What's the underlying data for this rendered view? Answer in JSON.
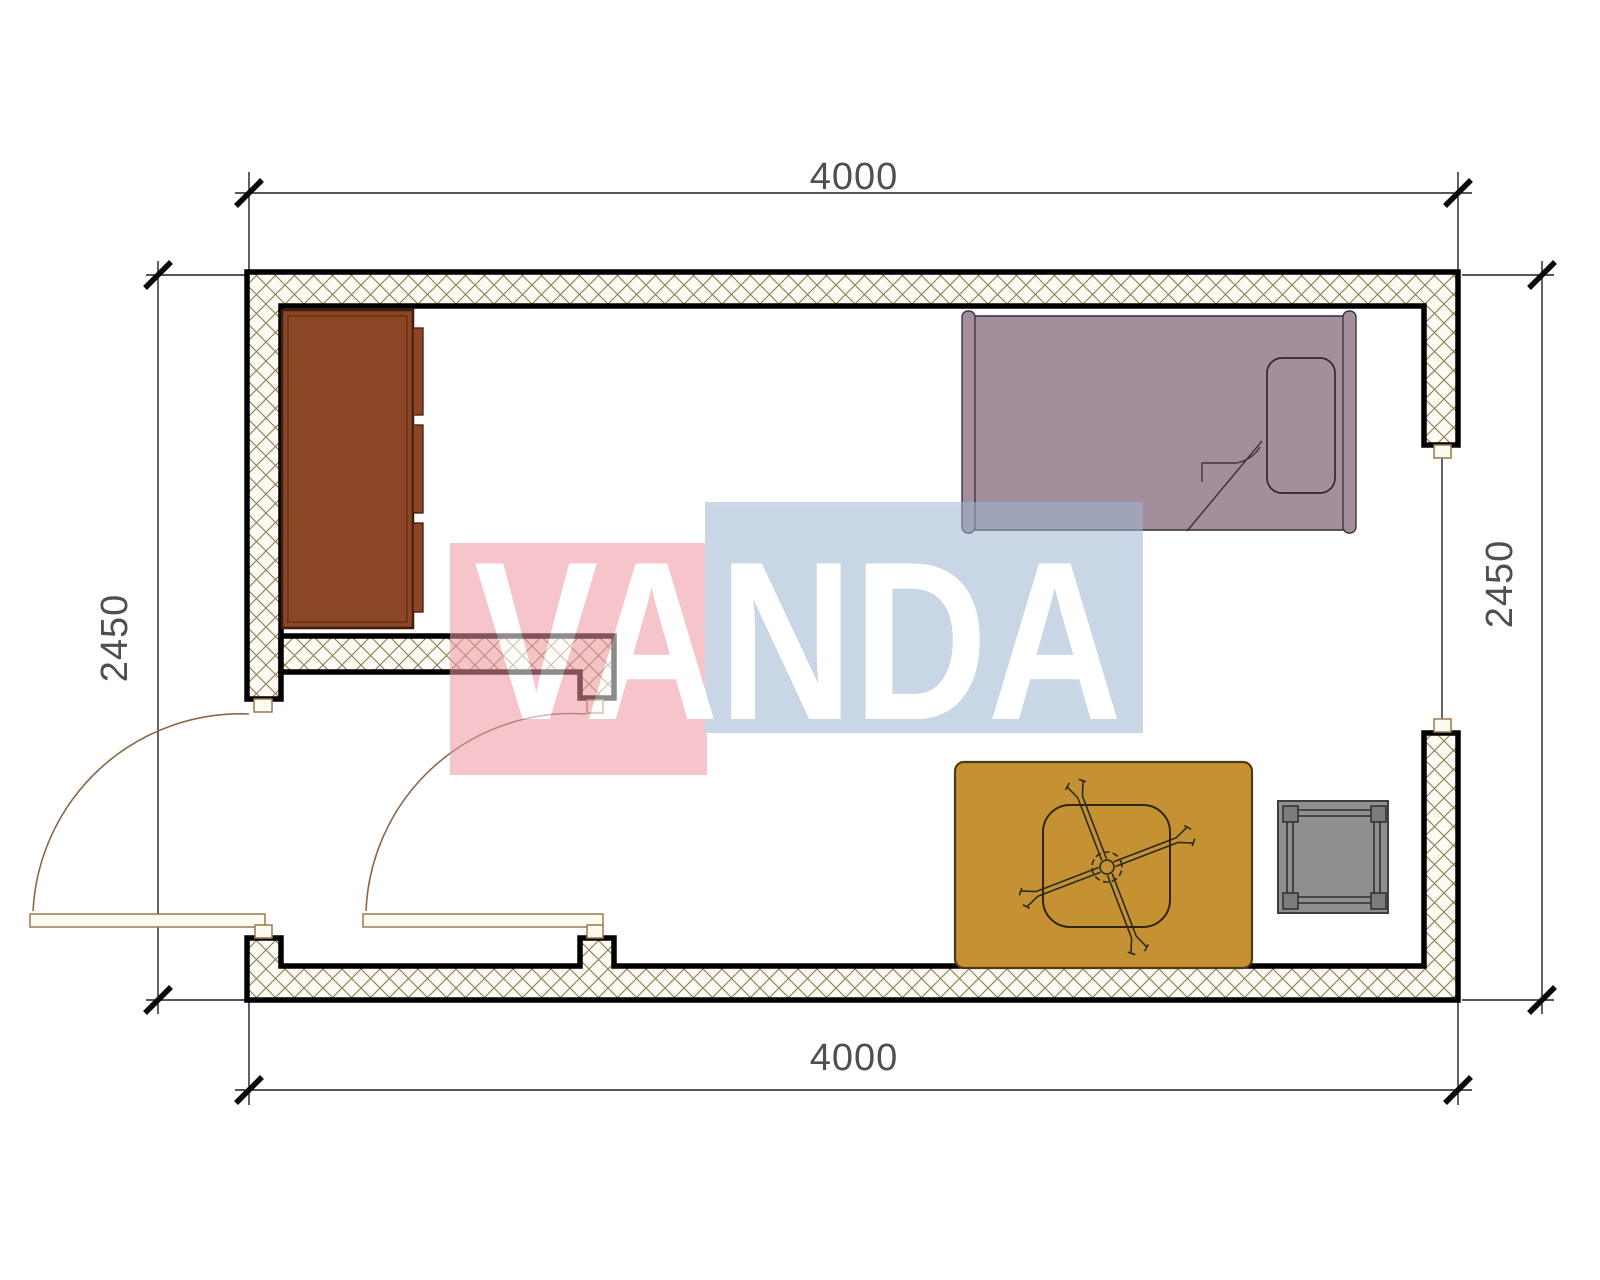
{
  "plan": {
    "type": "floor-plan",
    "room_width_mm": "4000",
    "room_depth_mm": "2450"
  },
  "dimensions": {
    "top": "4000",
    "bottom": "4000",
    "left": "2450",
    "right": "2450"
  },
  "watermark": {
    "text": "VANDA",
    "pink": "#ef97a2",
    "blue": "#9cb6d3"
  },
  "colors": {
    "wall_outline": "#000000",
    "wall_hatch_bg": "#fcfaf2",
    "wall_hatch_line": "#8d7c52",
    "wardrobe": "#8c4626",
    "wardrobe_outline": "#3f1d0c",
    "bed": "#a38f9b",
    "bed_outline": "#3e3440",
    "rug": "#c49133",
    "rug_outline": "#4f3b11",
    "table_outline": "#32250b",
    "stool": "#8f8f8f",
    "stool_corner": "#7c7c7c",
    "door": "#9a7b4e",
    "window_glass": "#3c3c54",
    "dimension_text": "#4f4f4f"
  },
  "furniture": [
    {
      "name": "wardrobe"
    },
    {
      "name": "single-bed"
    },
    {
      "name": "pillow"
    },
    {
      "name": "rug"
    },
    {
      "name": "table"
    },
    {
      "name": "ceiling-fan-symbol"
    },
    {
      "name": "stool"
    }
  ],
  "openings": [
    {
      "name": "entry-door-left"
    },
    {
      "name": "interior-door"
    },
    {
      "name": "window-right"
    }
  ]
}
